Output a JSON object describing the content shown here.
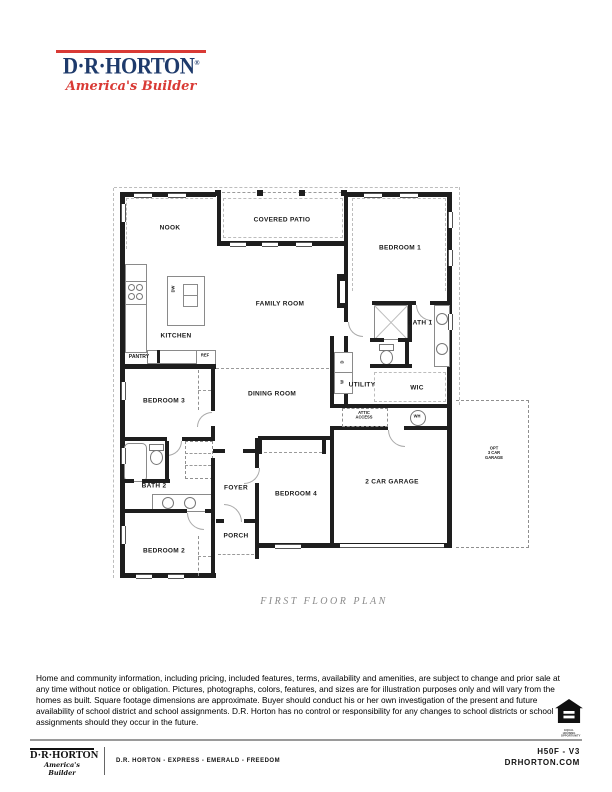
{
  "logo": {
    "name": "D·R·HORTON",
    "registered": "®",
    "tagline": "America's Builder"
  },
  "floor_plan": {
    "caption": "FIRST FLOOR PLAN",
    "rooms": {
      "nook": "NOOK",
      "covered_patio": "COVERED PATIO",
      "bedroom1": "BEDROOM 1",
      "family_room": "FAMILY ROOM",
      "kitchen": "KITCHEN",
      "bath1": "BATH 1",
      "pantry": "PANTRY",
      "dining_room": "DINING ROOM",
      "bedroom3": "BEDROOM 3",
      "utility": "UTILITY",
      "wic": "WIC",
      "bath2": "BATH 2",
      "foyer": "FOYER",
      "bedroom4": "BEDROOM 4",
      "garage": "2 CAR GARAGE",
      "bedroom2": "BEDROOM 2",
      "porch": "PORCH"
    },
    "fixtures": {
      "ref": "REF",
      "dw": "DW",
      "wh": "WH",
      "dryer": "D",
      "washer": "W",
      "attic_lines": [
        "ATTIC",
        "ACCESS"
      ],
      "opt_garage_lines": [
        "OPT",
        "3 CAR",
        "GARAGE"
      ]
    }
  },
  "disclaimer": "Home and community information, including pricing, included features, terms, availability and amenities, are subject to change and prior sale at any time without notice or obligation. Pictures, photographs, colors, features, and sizes are for illustration purposes only and will vary from the homes as built. Square footage dimensions are approximate. Buyer should conduct his or her own investigation of the present and future availability of school district and school assignments. D.R. Horton has no control or responsibility for any changes to school districts or school assignments should they occur in the future.",
  "footer": {
    "logo_name": "D·R·HORTON",
    "logo_tagline": "America's Builder",
    "brands": "D.R. HORTON - EXPRESS - EMERALD - FREEDOM",
    "plan_code": "H50F - V3",
    "website": "DRHORTON.COM",
    "equal_housing": "EQUAL HOUSING OPPORTUNITY"
  },
  "colors": {
    "brand_navy": "#1e3a6b",
    "brand_red": "#d93a35",
    "wall_black": "#1e1e1e"
  }
}
